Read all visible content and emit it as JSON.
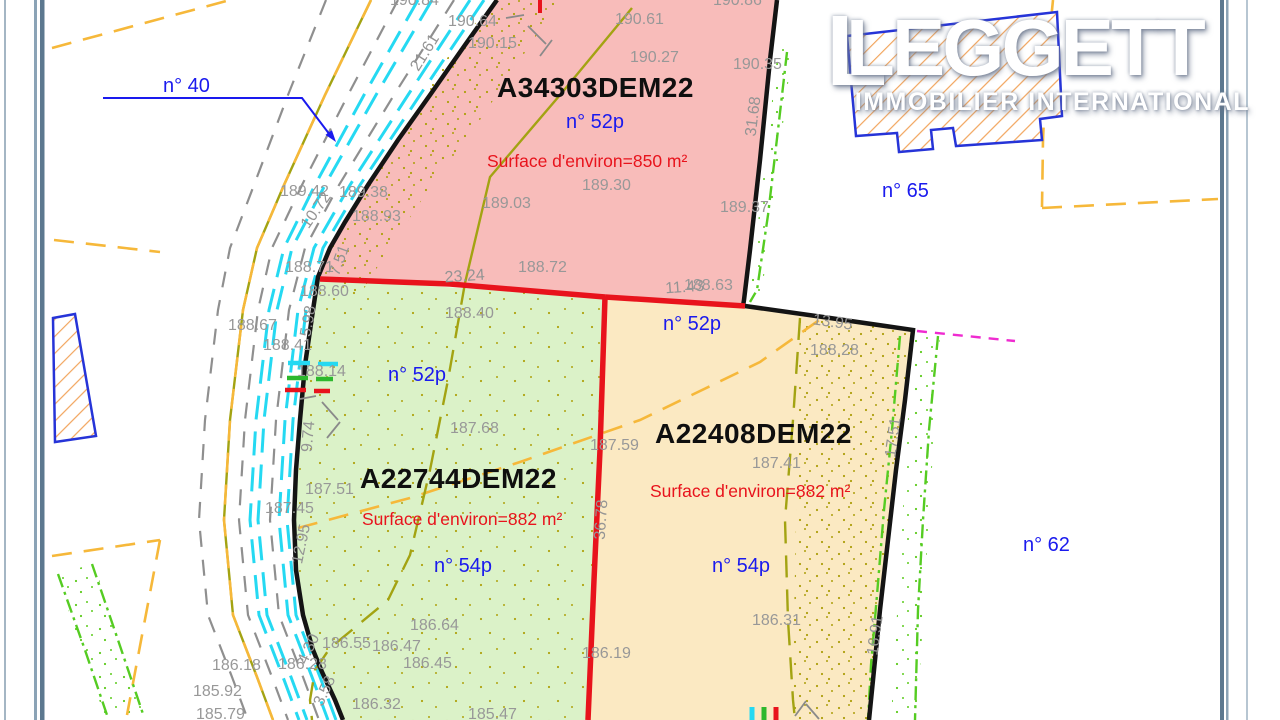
{
  "logo": {
    "mark": "L",
    "title": "LEGGETT",
    "subtitle": "IMMOBILIER INTERNATIONAL"
  },
  "colors": {
    "parcel_pink": "#f8bcba",
    "parcel_green": "#dbf2c8",
    "parcel_orange": "#fbe9c2",
    "boundary_black": "#141414",
    "division_red": "#e8131c",
    "label_blue": "#1a1aee",
    "label_gray": "#989898",
    "water_cyan": "#25d9f2",
    "cadastre_orange": "#f6b83a",
    "contour_olive": "#a3a312",
    "vegetation_green": "#55cc22",
    "magenta_line": "#ef2bd0",
    "building_blue": "#2634d8",
    "hatch_orange": "#f2a55e",
    "frame_slate": "#5c788f"
  },
  "parcels": [
    {
      "id": "A34303DEM22",
      "number": "n° 52p",
      "surface": "Surface d'environ=850 m²",
      "fill": "#f8bcba",
      "id_pos": [
        497,
        97
      ],
      "number_pos": [
        566,
        128
      ],
      "surface_pos": [
        487,
        167
      ]
    },
    {
      "id": "A22744DEM22",
      "number": "n° 54p",
      "number2": "n° 52p",
      "surface": "Surface d'environ=882 m²",
      "fill": "#dbf2c8",
      "id_pos": [
        360,
        488
      ],
      "number_pos": [
        434,
        572
      ],
      "number2_pos": [
        388,
        381
      ],
      "surface_pos": [
        362,
        525
      ]
    },
    {
      "id": "A22408DEM22",
      "number": "n° 54p",
      "number2": "n° 52p",
      "surface": "Surface d'environ=882 m²",
      "fill": "#fbe9c2",
      "id_pos": [
        655,
        443
      ],
      "number_pos": [
        712,
        572
      ],
      "number2_pos": [
        663,
        330
      ],
      "surface_pos": [
        650,
        497
      ]
    }
  ],
  "neighbors": [
    {
      "label": "n° 40",
      "pos": [
        163,
        92
      ]
    },
    {
      "label": "n° 65",
      "pos": [
        882,
        197
      ]
    },
    {
      "label": "n° 62",
      "pos": [
        1023,
        551
      ]
    }
  ],
  "annotations": {
    "elevations": [
      {
        "t": "190.84",
        "x": 390,
        "y": 5
      },
      {
        "t": "190.86",
        "x": 713,
        "y": 5
      },
      {
        "t": "190.64",
        "x": 448,
        "y": 26
      },
      {
        "t": "190.15",
        "x": 468,
        "y": 48
      },
      {
        "t": "190.61",
        "x": 615,
        "y": 24
      },
      {
        "t": "190.27",
        "x": 630,
        "y": 62
      },
      {
        "t": "190.35",
        "x": 733,
        "y": 69
      },
      {
        "t": "189.42",
        "x": 280,
        "y": 196
      },
      {
        "t": "189.38",
        "x": 339,
        "y": 197
      },
      {
        "t": "188.93",
        "x": 352,
        "y": 221
      },
      {
        "t": "189.03",
        "x": 482,
        "y": 208
      },
      {
        "t": "189.30",
        "x": 582,
        "y": 190
      },
      {
        "t": "189.37",
        "x": 720,
        "y": 212
      },
      {
        "t": "188.72",
        "x": 518,
        "y": 272
      },
      {
        "t": "188.63",
        "x": 684,
        "y": 290
      },
      {
        "t": "188.71",
        "x": 285,
        "y": 272
      },
      {
        "t": "188.60",
        "x": 300,
        "y": 296
      },
      {
        "t": "188.40",
        "x": 445,
        "y": 318
      },
      {
        "t": "188.67",
        "x": 228,
        "y": 330
      },
      {
        "t": "188.41",
        "x": 263,
        "y": 350
      },
      {
        "t": "188.14",
        "x": 297,
        "y": 376
      },
      {
        "t": "188.28",
        "x": 810,
        "y": 355
      },
      {
        "t": "187.68",
        "x": 450,
        "y": 433
      },
      {
        "t": "187.59",
        "x": 590,
        "y": 450
      },
      {
        "t": "187.41",
        "x": 752,
        "y": 468
      },
      {
        "t": "187.51",
        "x": 305,
        "y": 494
      },
      {
        "t": "187.45",
        "x": 265,
        "y": 513
      },
      {
        "t": "186.64",
        "x": 410,
        "y": 630
      },
      {
        "t": "186.55",
        "x": 322,
        "y": 648
      },
      {
        "t": "186.47",
        "x": 372,
        "y": 651
      },
      {
        "t": "186.45",
        "x": 403,
        "y": 668
      },
      {
        "t": "186.18",
        "x": 212,
        "y": 670
      },
      {
        "t": "186.28",
        "x": 278,
        "y": 669
      },
      {
        "t": "185.92",
        "x": 193,
        "y": 696
      },
      {
        "t": "186.32",
        "x": 352,
        "y": 709
      },
      {
        "t": "186.19",
        "x": 582,
        "y": 658
      },
      {
        "t": "186.31",
        "x": 752,
        "y": 625
      },
      {
        "t": "185.79",
        "x": 196,
        "y": 719
      },
      {
        "t": "185.47",
        "x": 468,
        "y": 719
      }
    ],
    "dimensions": [
      {
        "t": "21.61",
        "x": 429,
        "y": 55,
        "r": -58
      },
      {
        "t": "10.72",
        "x": 320,
        "y": 213,
        "r": -55
      },
      {
        "t": "7.51",
        "x": 344,
        "y": 262,
        "r": -70
      },
      {
        "t": "31.68",
        "x": 758,
        "y": 117,
        "r": -83
      },
      {
        "t": "23.24",
        "x": 465,
        "y": 281,
        "r": -4
      },
      {
        "t": "11.43",
        "x": 685,
        "y": 292,
        "r": -4
      },
      {
        "t": "13.95",
        "x": 832,
        "y": 327,
        "r": 8
      },
      {
        "t": "5.98",
        "x": 313,
        "y": 322,
        "r": -80
      },
      {
        "t": "9.74",
        "x": 313,
        "y": 437,
        "r": -85
      },
      {
        "t": "12.95",
        "x": 306,
        "y": 545,
        "r": -78
      },
      {
        "t": "4.30",
        "x": 313,
        "y": 651,
        "r": -65
      },
      {
        "t": "3.58",
        "x": 329,
        "y": 693,
        "r": -65
      },
      {
        "t": "36.78",
        "x": 606,
        "y": 520,
        "r": -86
      },
      {
        "t": "17.51",
        "x": 898,
        "y": 438,
        "r": -82
      },
      {
        "t": "16.91",
        "x": 880,
        "y": 636,
        "r": -82
      }
    ]
  }
}
